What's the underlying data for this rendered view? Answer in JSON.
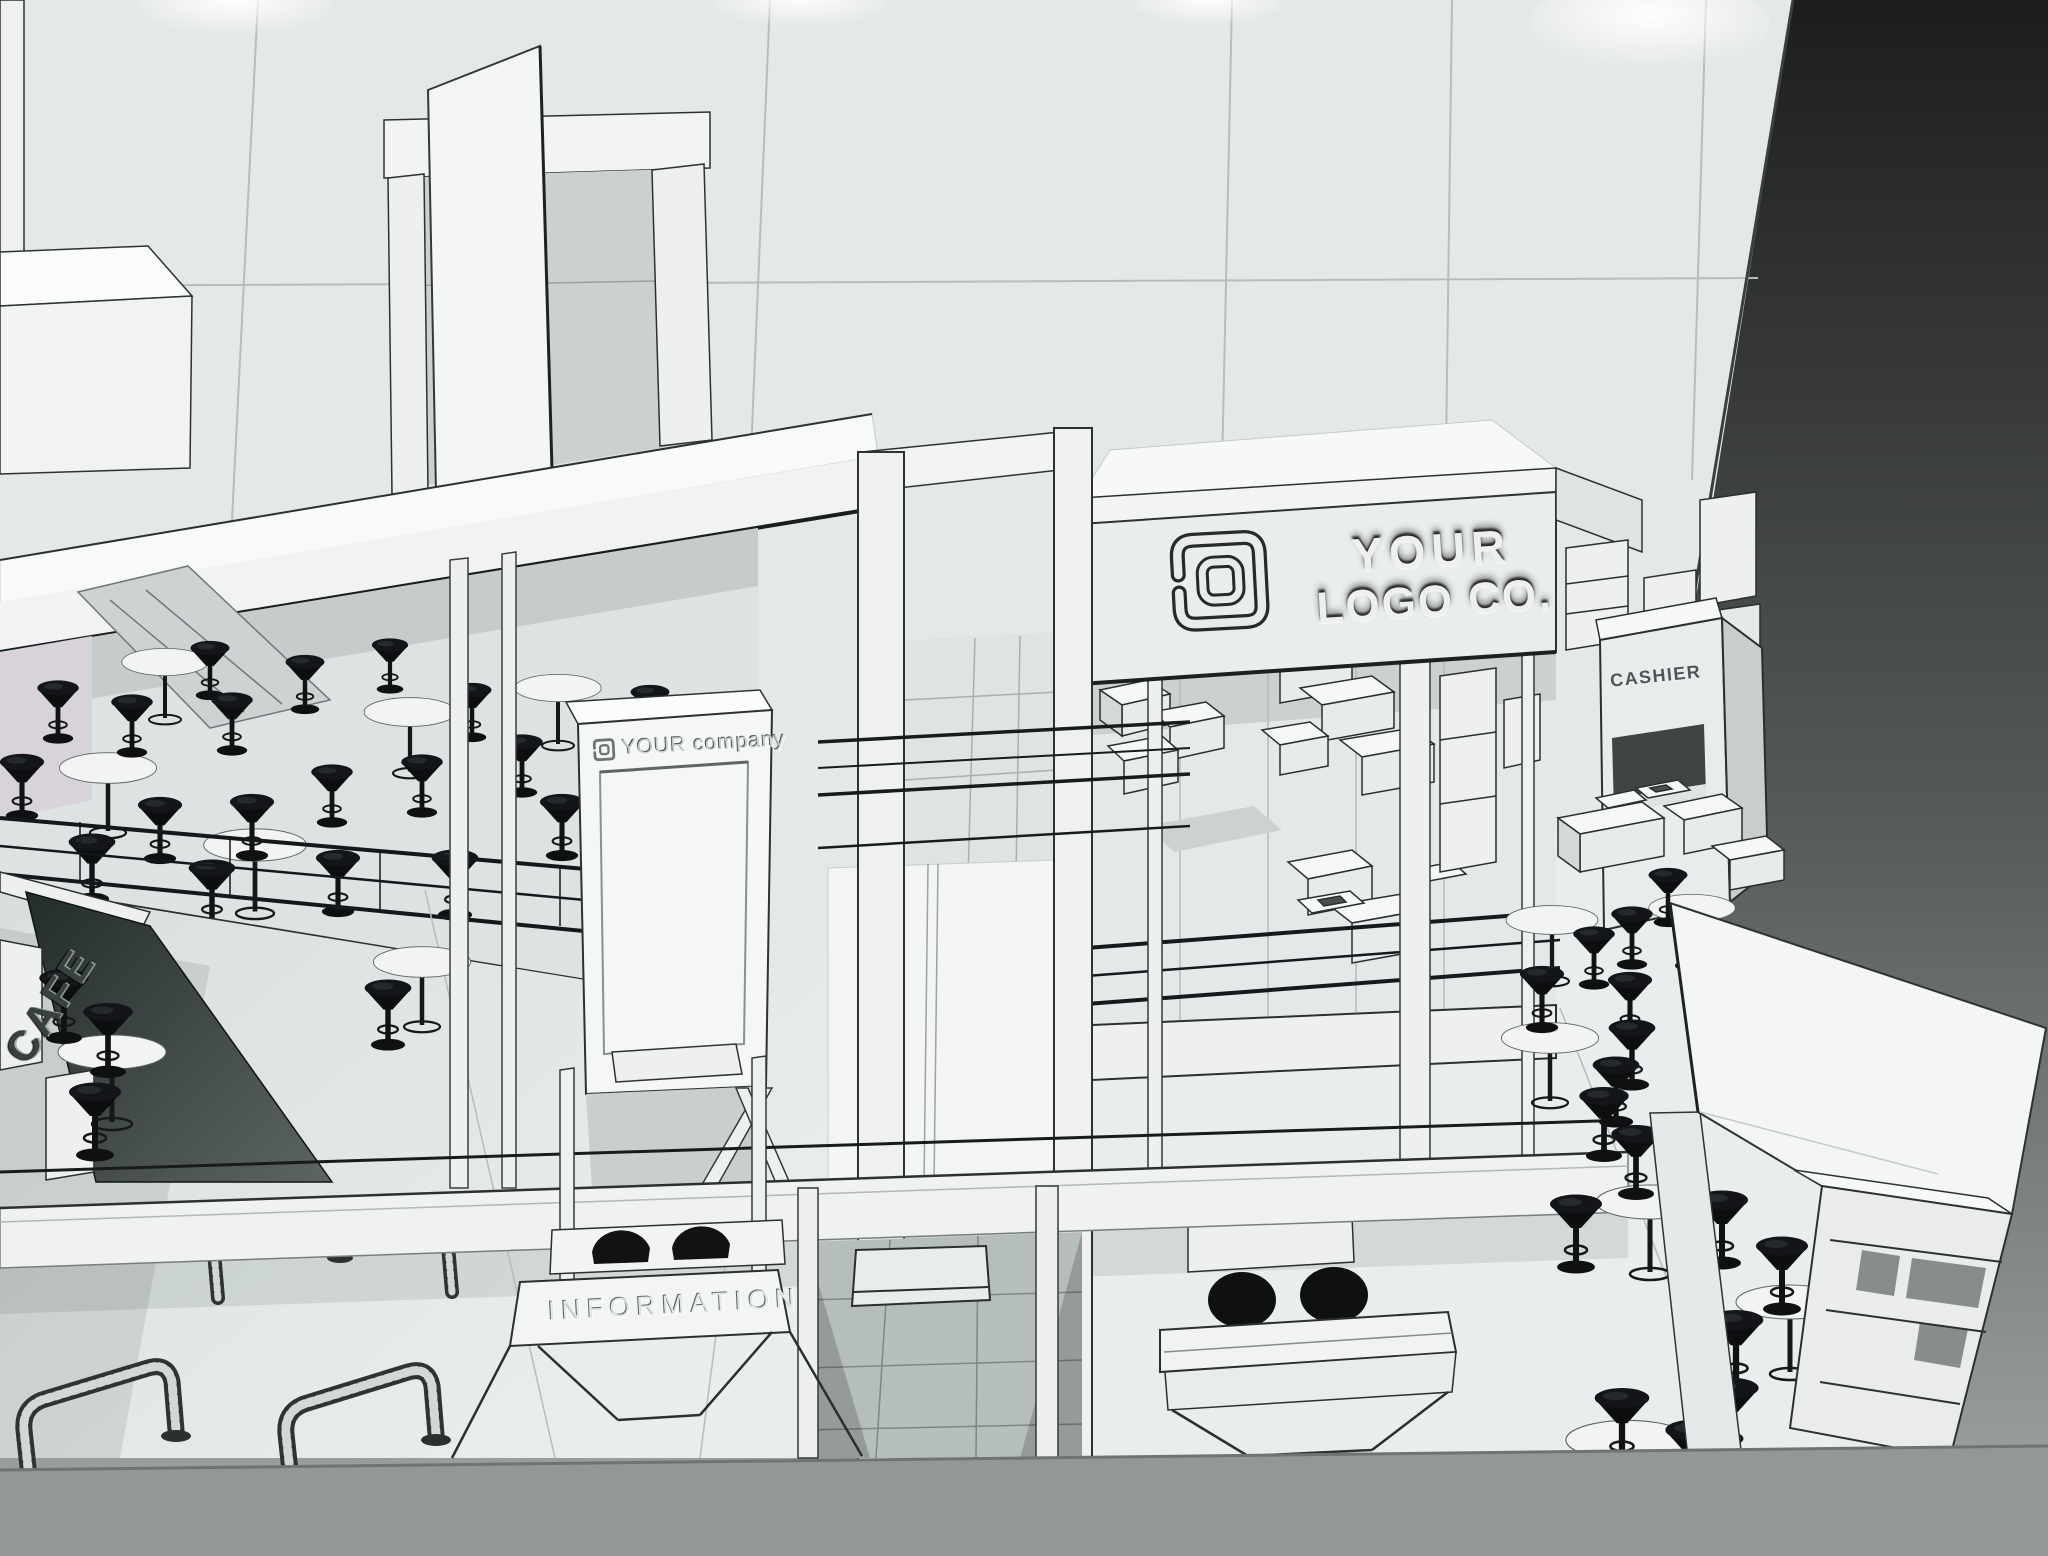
{
  "signs": {
    "fascia": {
      "line1": "YOUR",
      "line2": "LOGO CO."
    },
    "tower": {
      "label": "YOUR company"
    },
    "information": {
      "label": "INFORMATION"
    },
    "cashier": {
      "label": "CASHIER"
    },
    "cafe": {
      "label": "CAFE"
    }
  },
  "icons": {
    "company_logo": "nested rounded-square spiral mark"
  },
  "colors": {
    "background_top": "#1e1e1e",
    "background_bottom": "#9aa0a0",
    "wall": "#e4e7e7",
    "structure_white": "#f2f4f4",
    "floor": "#e0e4e4",
    "furniture_black": "#0e1012",
    "edge_dark": "#24282a",
    "cafe_panel": "#2f3636"
  }
}
